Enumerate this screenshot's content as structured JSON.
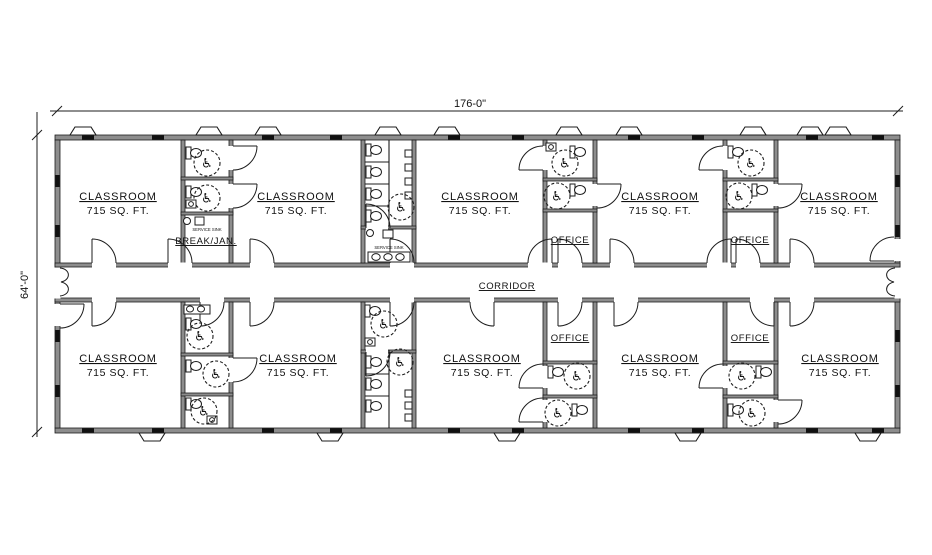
{
  "dimensions": {
    "width": "176-0\"",
    "height": "64'-0\""
  },
  "corridor": {
    "label": "CORRIDOR"
  },
  "rooms": [
    {
      "id": "classroom-upper-1",
      "label": "CLASSROOM",
      "area": "715 SQ. FT."
    },
    {
      "id": "classroom-upper-2",
      "label": "CLASSROOM",
      "area": "715 SQ. FT."
    },
    {
      "id": "classroom-upper-3",
      "label": "CLASSROOM",
      "area": "715 SQ. FT."
    },
    {
      "id": "classroom-upper-4",
      "label": "CLASSROOM",
      "area": "715 SQ. FT."
    },
    {
      "id": "classroom-upper-5",
      "label": "CLASSROOM",
      "area": "715 SQ. FT."
    },
    {
      "id": "classroom-lower-1",
      "label": "CLASSROOM",
      "area": "715 SQ. FT."
    },
    {
      "id": "classroom-lower-2",
      "label": "CLASSROOM",
      "area": "715 SQ. FT."
    },
    {
      "id": "classroom-lower-3",
      "label": "CLASSROOM",
      "area": "715 SQ. FT."
    },
    {
      "id": "classroom-lower-4",
      "label": "CLASSROOM",
      "area": "715 SQ. FT."
    },
    {
      "id": "classroom-lower-5",
      "label": "CLASSROOM",
      "area": "715 SQ. FT."
    },
    {
      "id": "office-upper-left",
      "label": "OFFICE"
    },
    {
      "id": "office-upper-right",
      "label": "OFFICE"
    },
    {
      "id": "office-lower-left",
      "label": "OFFICE"
    },
    {
      "id": "office-lower-right",
      "label": "OFFICE"
    },
    {
      "id": "break-jan",
      "label": "BREAK/JAN."
    }
  ],
  "annotations": {
    "service_sink": "SERVICE SINK"
  },
  "icons": {
    "accessible": "♿"
  },
  "colors": {
    "wall_fill": "#8d8d8d",
    "line": "#1c1c1c",
    "background": "#ffffff"
  }
}
